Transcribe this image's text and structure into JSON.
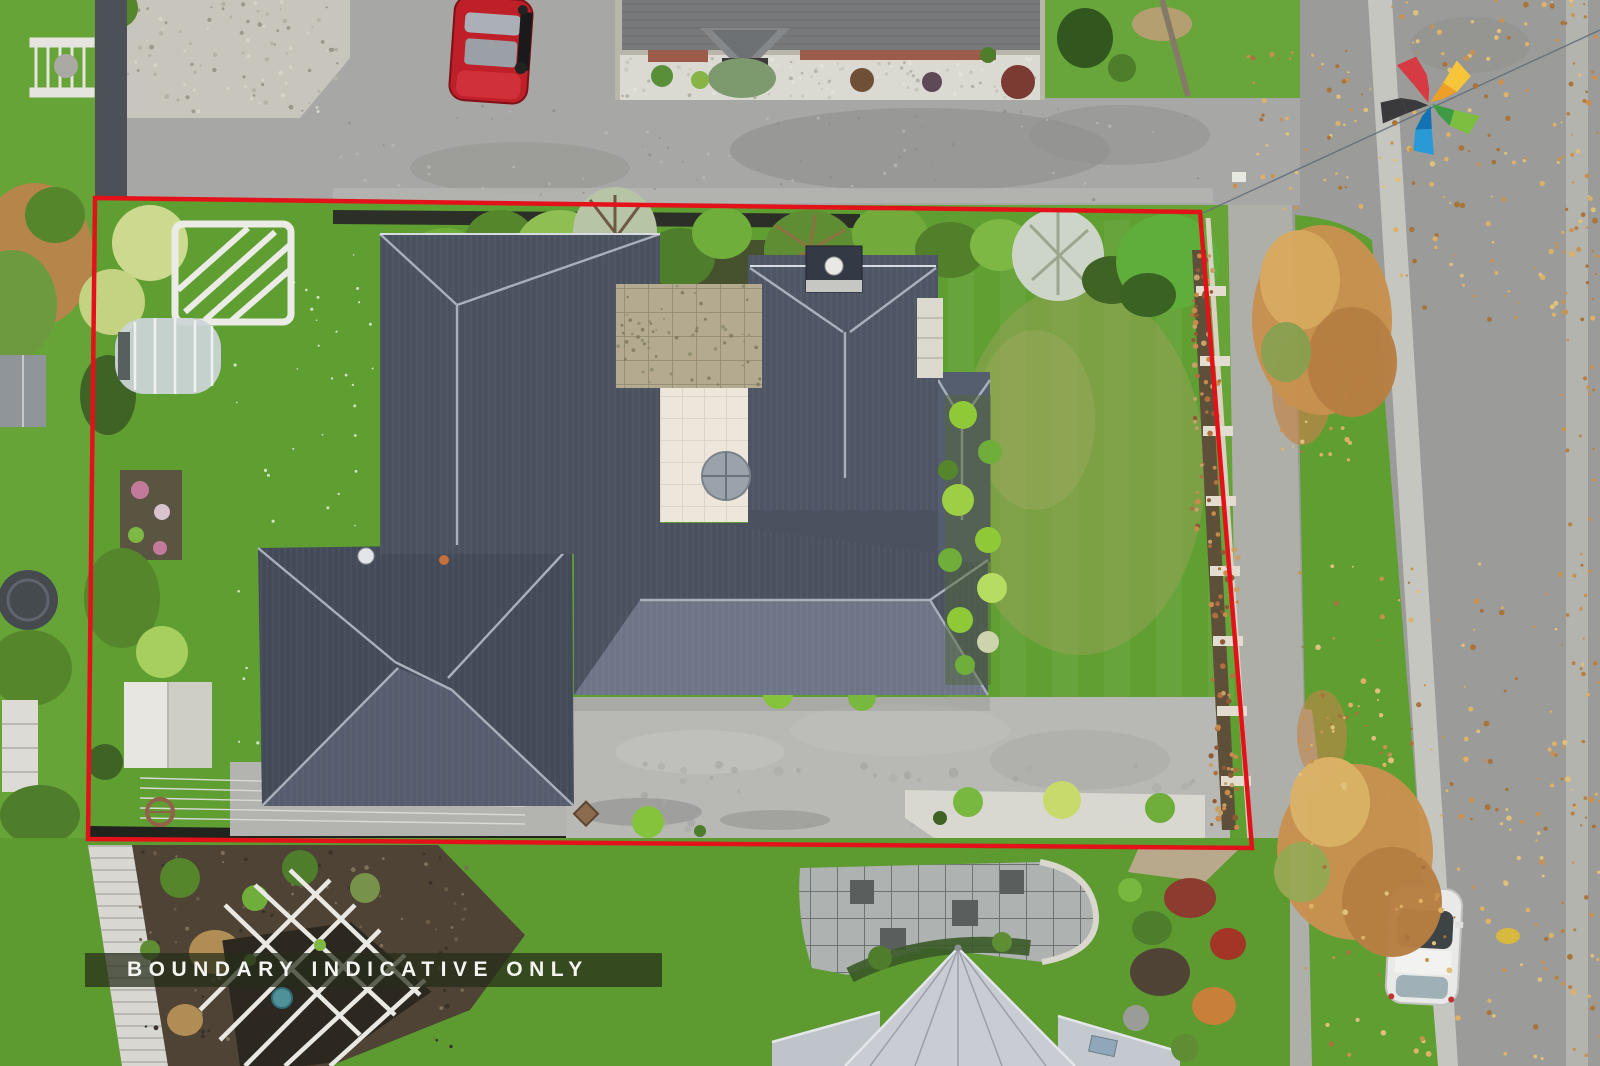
{
  "watermark": {
    "label": "BOUNDARY INDICATIVE ONLY",
    "text_color": "#f4f4f1",
    "band_color": "#262c19"
  },
  "boundary": {
    "color": "#e3121a"
  },
  "logo": {
    "name": "five-arm-pinwheel-star",
    "arm_colors": {
      "red": "#d63a43",
      "orange": "#ef9f28",
      "yellow": "#f6c53a",
      "green": "#7cbe3f",
      "green_dark": "#3f9a44",
      "blue": "#2a9ad6",
      "blue_dark": "#1273b4",
      "black": "#3a3a3c"
    }
  },
  "scene": {
    "palette": {
      "lawn": "#5f9e31",
      "lawn_dry_patch": "#97a258",
      "main_roof": "#4a5260",
      "main_roof_light": "#6d7587",
      "ridge": "#a9b0bb",
      "road": "#9b9c99",
      "driveway": "#b8b9b5",
      "footpath": "#aeafa9",
      "autumn_foliage": "#c8914f",
      "neighbor_roof": "#c9cdd3",
      "red_car": "#bf1f28",
      "white_car": "#e9eae8"
    }
  }
}
